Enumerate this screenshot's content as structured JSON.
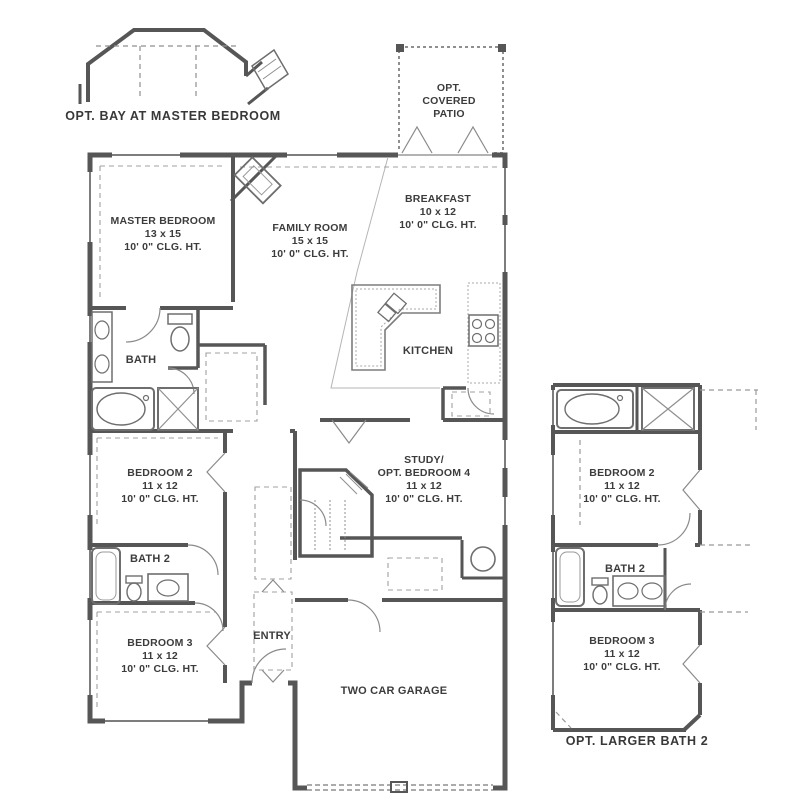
{
  "colors": {
    "wall": "#565656",
    "fixture": "#6e6e6e",
    "light_line": "#a8a8a8",
    "dashed_line": "#8f8f8f",
    "text": "#3c3c3c",
    "background": "#ffffff"
  },
  "options": {
    "bay_caption": "OPT. BAY AT MASTER BEDROOM",
    "patio": {
      "line1": "OPT.",
      "line2": "COVERED",
      "line3": "PATIO"
    },
    "larger_bath_caption": "OPT. LARGER BATH 2"
  },
  "rooms": {
    "master": {
      "name": "MASTER BEDROOM",
      "dims": "13 x 15",
      "clg": "10' 0\" CLG. HT."
    },
    "family": {
      "name": "FAMILY ROOM",
      "dims": "15 x 15",
      "clg": "10' 0\" CLG. HT."
    },
    "breakfast": {
      "name": "BREAKFAST",
      "dims": "10 x 12",
      "clg": "10' 0\" CLG. HT."
    },
    "kitchen": {
      "name": "KITCHEN"
    },
    "bath": {
      "name": "BATH"
    },
    "bedroom2": {
      "name": "BEDROOM 2",
      "dims": "11 x 12",
      "clg": "10' 0\" CLG. HT."
    },
    "bath2": {
      "name": "BATH 2"
    },
    "bedroom3": {
      "name": "BEDROOM 3",
      "dims": "11 x 12",
      "clg": "10' 0\" CLG. HT."
    },
    "study": {
      "name1": "STUDY/",
      "name2": "OPT. BEDROOM 4",
      "dims": "11 x 12",
      "clg": "10' 0\" CLG. HT."
    },
    "entry": {
      "name": "ENTRY"
    },
    "garage": {
      "name": "TWO CAR GARAGE"
    }
  },
  "inset": {
    "bedroom2": {
      "name": "BEDROOM 2",
      "dims": "11 x 12",
      "clg": "10' 0\" CLG. HT."
    },
    "bath2": {
      "name": "BATH 2"
    },
    "bedroom3": {
      "name": "BEDROOM 3",
      "dims": "11 x 12",
      "clg": "10' 0\" CLG. HT."
    }
  }
}
